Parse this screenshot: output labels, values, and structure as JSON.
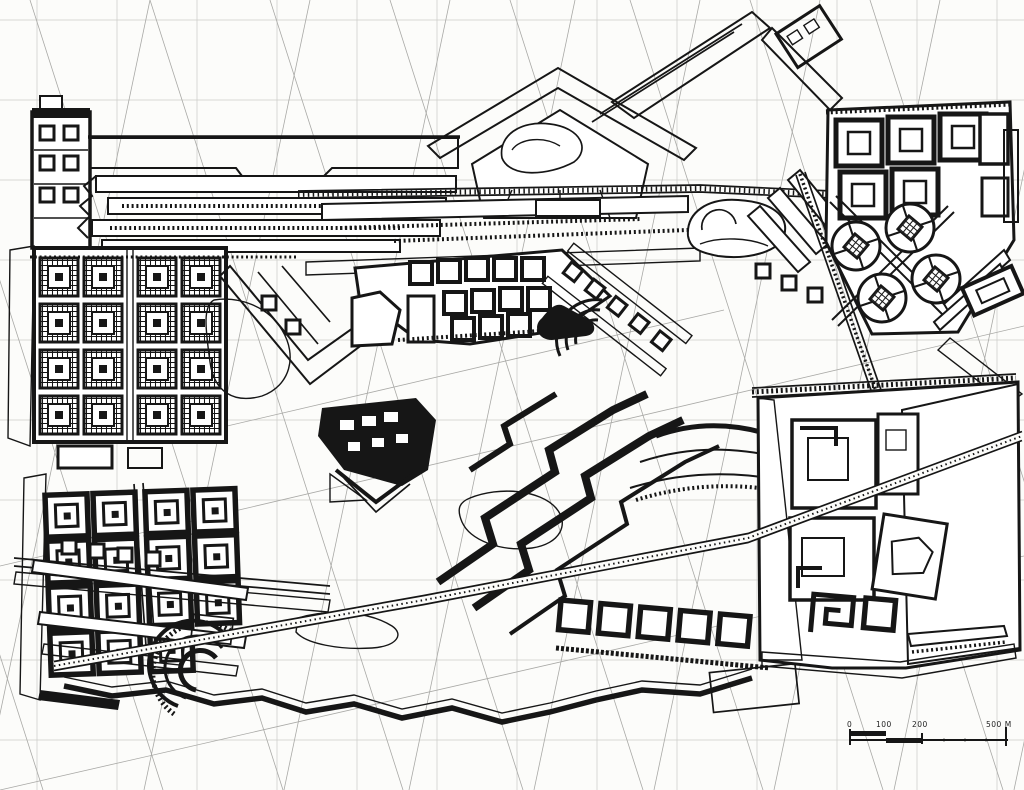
{
  "drawing": {
    "scale_bar": {
      "labels": [
        "0",
        "100",
        "200",
        "500 M"
      ]
    },
    "palette": {
      "paper": "#fcfcfa",
      "ink": "#161616",
      "pencil_grid": "#cbcbc8",
      "pencil_diagonal": "#a9a9a6"
    }
  }
}
